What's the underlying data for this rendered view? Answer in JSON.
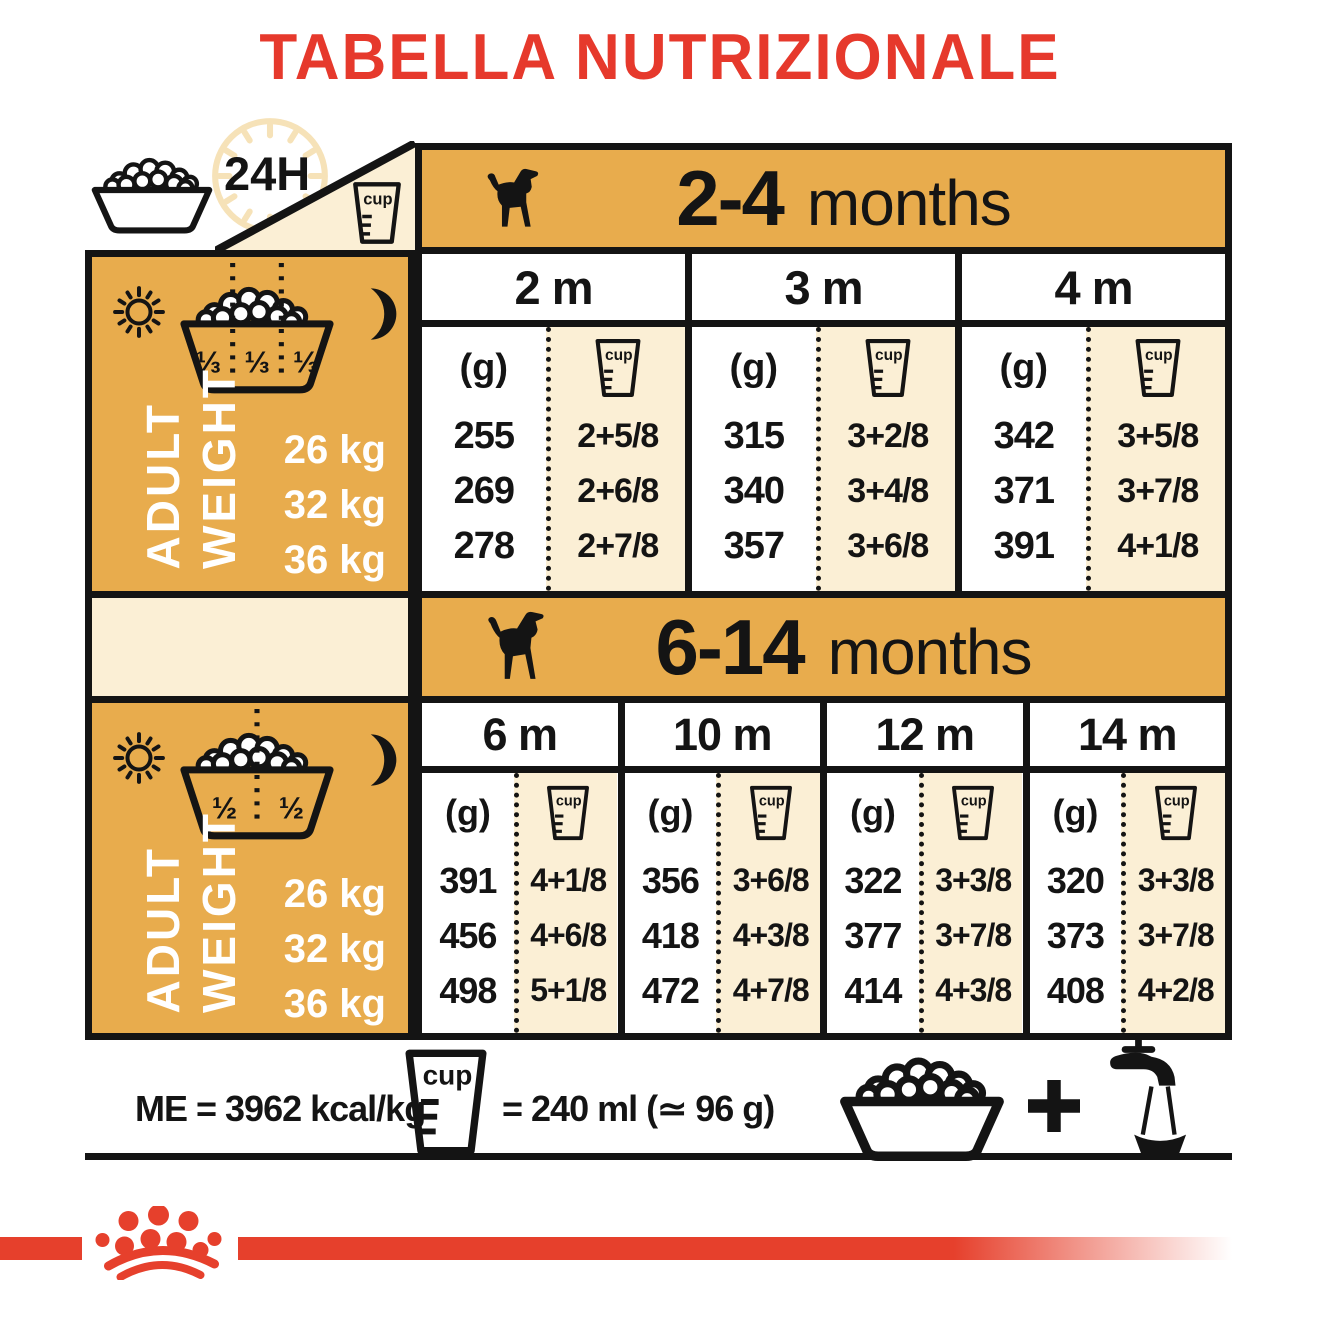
{
  "title": "TABELLA NUTRIZIONALE",
  "corner": {
    "hours_label": "24H"
  },
  "labels": {
    "grams": "(g)",
    "cup": "cup",
    "adult": "ADULT",
    "weight": "WEIGHT"
  },
  "colors": {
    "gold": "#E8AC4D",
    "cream": "#FBEFD5",
    "red": "#E6402C",
    "ink": "#141414"
  },
  "sections": [
    {
      "age_bold": "2-4",
      "age_word": "months",
      "bowl_fractions": [
        "⅓",
        "⅓",
        "⅓"
      ],
      "weights": [
        "26 kg",
        "32 kg",
        "36 kg"
      ],
      "columns": [
        {
          "month": "2 m",
          "grams": [
            "255",
            "269",
            "278"
          ],
          "cups": [
            "2+5/8",
            "2+6/8",
            "2+7/8"
          ]
        },
        {
          "month": "3 m",
          "grams": [
            "315",
            "340",
            "357"
          ],
          "cups": [
            "3+2/8",
            "3+4/8",
            "3+6/8"
          ]
        },
        {
          "month": "4 m",
          "grams": [
            "342",
            "371",
            "391"
          ],
          "cups": [
            "3+5/8",
            "3+7/8",
            "4+1/8"
          ]
        }
      ]
    },
    {
      "age_bold": "6-14",
      "age_word": "months",
      "bowl_fractions": [
        "½",
        "½"
      ],
      "weights": [
        "26 kg",
        "32 kg",
        "36 kg"
      ],
      "columns": [
        {
          "month": "6 m",
          "grams": [
            "391",
            "456",
            "498"
          ],
          "cups": [
            "4+1/8",
            "4+6/8",
            "5+1/8"
          ]
        },
        {
          "month": "10 m",
          "grams": [
            "356",
            "418",
            "472"
          ],
          "cups": [
            "3+6/8",
            "4+3/8",
            "4+7/8"
          ]
        },
        {
          "month": "12 m",
          "grams": [
            "322",
            "377",
            "414"
          ],
          "cups": [
            "3+3/8",
            "3+7/8",
            "4+3/8"
          ]
        },
        {
          "month": "14 m",
          "grams": [
            "320",
            "373",
            "408"
          ],
          "cups": [
            "3+3/8",
            "3+7/8",
            "4+2/8"
          ]
        }
      ]
    }
  ],
  "footer": {
    "me": "ME = 3962 kcal/kg",
    "equiv": "= 240 ml (≃ 96 g)"
  }
}
